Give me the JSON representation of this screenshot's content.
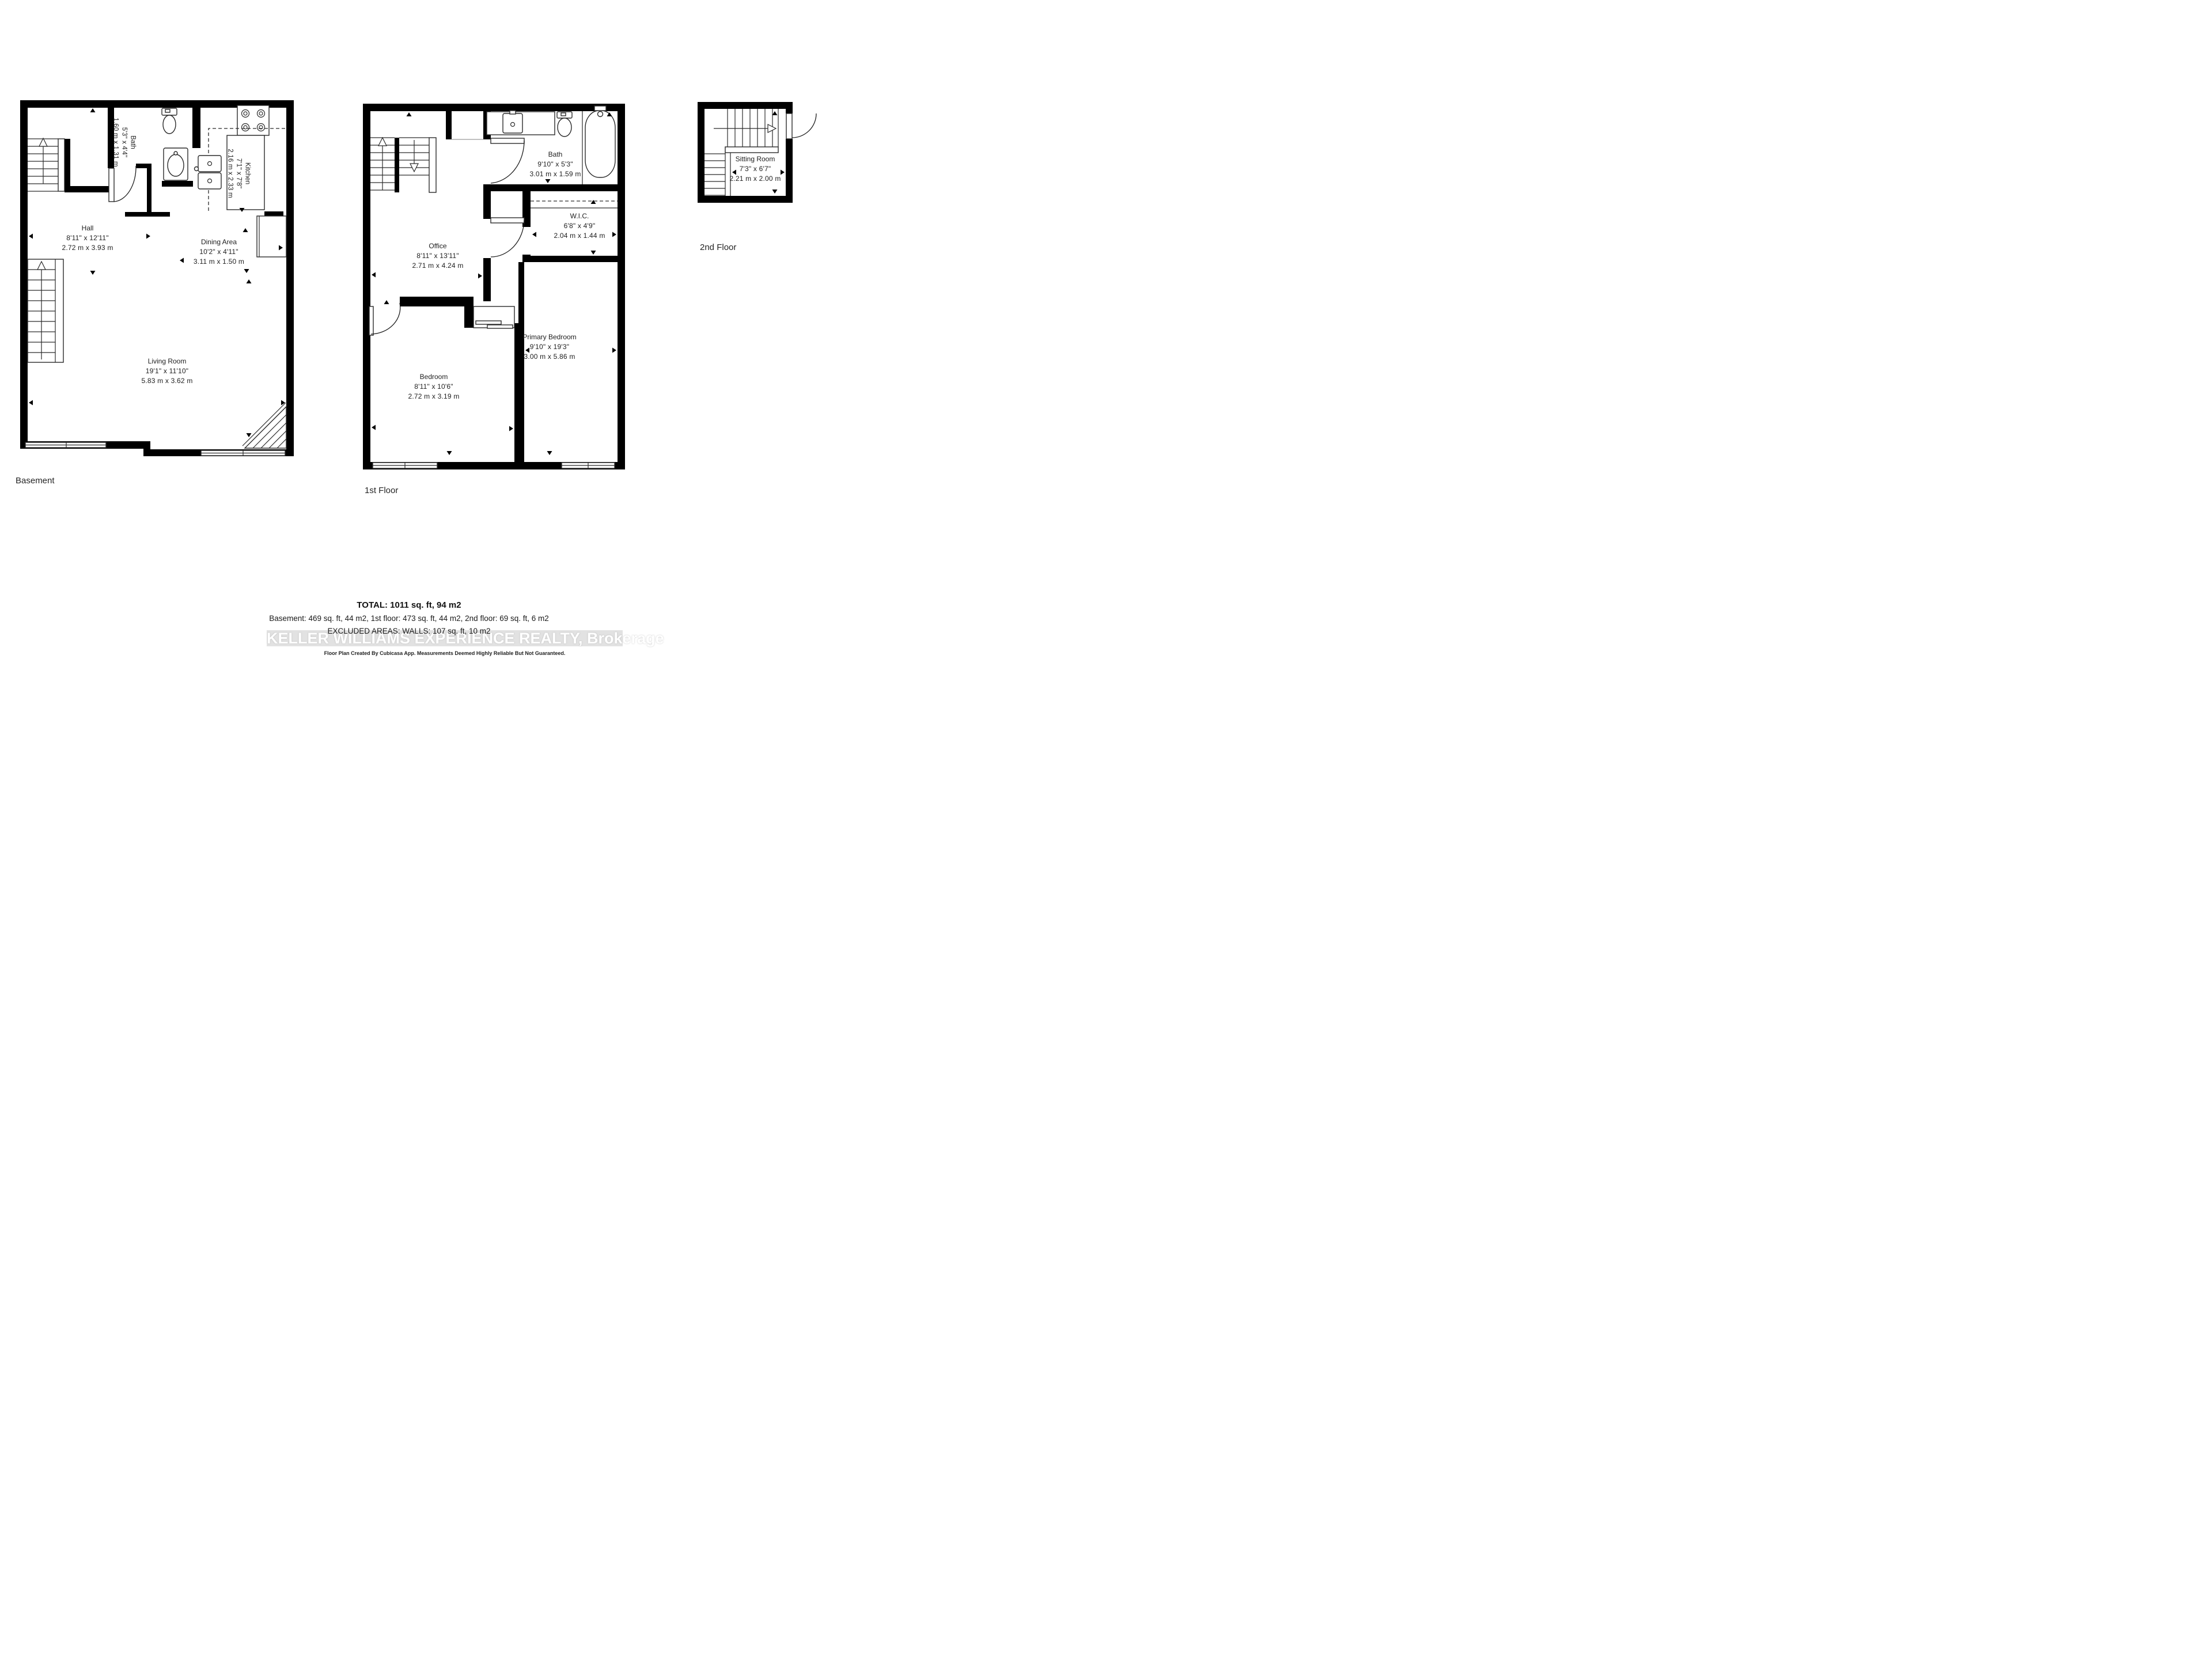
{
  "floors": [
    {
      "label": "Basement",
      "rooms": [
        {
          "name": "Hall",
          "imperial": "8'11\" x 12'11\"",
          "metric": "2.72 m x 3.93 m"
        },
        {
          "name": "Bath",
          "imperial": "5'3\" x 4'4\"",
          "metric": "1.60 m x 1.31 m"
        },
        {
          "name": "Kitchen",
          "imperial": "7'1\" x 7'8\"",
          "metric": "2.16 m x 2.33 m"
        },
        {
          "name": "Dining Area",
          "imperial": "10'2\" x 4'11\"",
          "metric": "3.11 m x 1.50 m"
        },
        {
          "name": "Living Room",
          "imperial": "19'1\" x 11'10\"",
          "metric": "5.83 m x 3.62 m"
        }
      ]
    },
    {
      "label": "1st Floor",
      "rooms": [
        {
          "name": "Bath",
          "imperial": "9'10\" x 5'3\"",
          "metric": "3.01 m x 1.59 m"
        },
        {
          "name": "W.I.C.",
          "imperial": "6'8\" x 4'9\"",
          "metric": "2.04 m x 1.44 m"
        },
        {
          "name": "Office",
          "imperial": "8'11\" x 13'11\"",
          "metric": "2.71 m x 4.24 m"
        },
        {
          "name": "Primary Bedroom",
          "imperial": "9'10\" x 19'3\"",
          "metric": "3.00 m x 5.86 m"
        },
        {
          "name": "Bedroom",
          "imperial": "8'11\" x 10'6\"",
          "metric": "2.72 m x 3.19 m"
        }
      ]
    },
    {
      "label": "2nd Floor",
      "rooms": [
        {
          "name": "Sitting Room",
          "imperial": "7'3\" x 6'7\"",
          "metric": "2.21 m x 2.00 m"
        }
      ]
    }
  ],
  "summary": {
    "total": "TOTAL: 1011 sq. ft, 94 m2",
    "breakdown": "Basement: 469 sq. ft, 44 m2, 1st floor: 473 sq. ft, 44 m2, 2nd floor: 69 sq. ft, 6 m2",
    "excluded": "EXCLUDED AREAS: WALLS: 107 sq. ft, 10 m2",
    "watermark": "KELLER WILLIAMS EXPERIENCE REALTY, Brokerage",
    "disclaimer": "Floor Plan Created By Cubicasa App. Measurements Deemed Highly Reliable But Not Guaranteed."
  },
  "colors": {
    "wall": "#000000",
    "text": "#1c1c1c",
    "watermark_band": "#e2e2e2",
    "watermark_text": "#ffffff"
  }
}
